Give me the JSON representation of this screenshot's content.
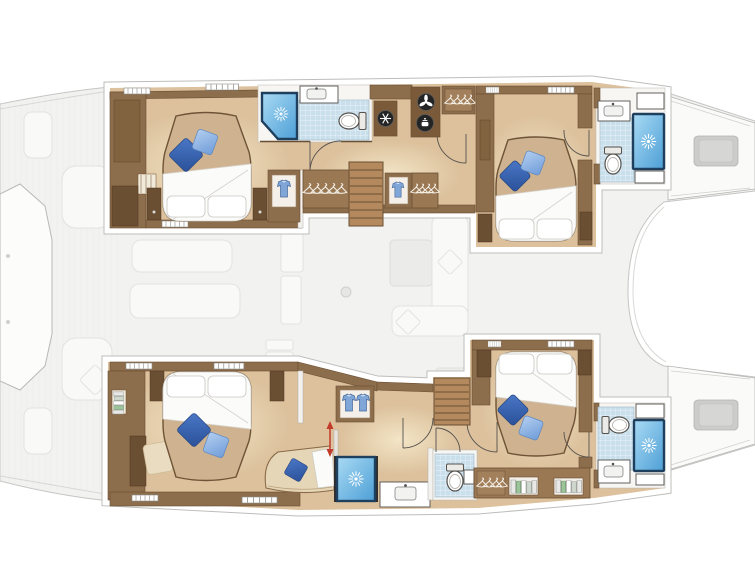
{
  "meta": {
    "title": "Catamaran 4-cabin layout — top-down floor plan",
    "diagram_type": "boat-floor-plan",
    "view": "overhead, lower-deck accommodations highlighted over faded main deck",
    "orientation": "bows to the right, sterns to the left"
  },
  "colors": {
    "page_bg": "#ffffff",
    "deck_faded": "#f2f2f1",
    "deck_outline": "#c5c5c3",
    "deck_furniture": "#f9f9f8",
    "deck_furniture_outline": "#e2e2e0",
    "deck_hatch": "#cccccb",
    "frame_white": "#ffffff",
    "frame_outline": "#bdbdbb",
    "floor_wood": "#dcc19c",
    "floor_glow": "#f4e7c9",
    "wall_wood": "#8d6e4c",
    "wood_dark": "#6b4f33",
    "furniture_wood": "#7b5a3a",
    "wardrobe_wood": "#9a7854",
    "stair_wood": "#b3895d",
    "bed_base": "#cfb390",
    "bed_outline": "#6e5336",
    "linen_white": "#fbfbfa",
    "linen_shadow": "#d6d4cf",
    "pillow_dark_1": "#4a77c6",
    "pillow_dark_2": "#2b5199",
    "pillow_light_1": "#b3cef0",
    "pillow_light_2": "#6f9cd8",
    "bath_floor": "#f7f6f3",
    "tile_blue": "#c9dfeb",
    "shower_glass_1": "#a9daf4",
    "shower_glass_2": "#4d9fd6",
    "shower_frame": "#1f3f5e",
    "fixture_white": "#ffffff",
    "fixture_line": "#55524e",
    "appliance_black": "#242424",
    "shirt_blue": "#7fa6d6",
    "accent_red": "#c23b2a",
    "rug_beige": "#e9dcc0",
    "chaise_beige": "#e6d6b8"
  },
  "counts": {
    "cabins": 4,
    "double_beds": 4,
    "bathrooms": 3,
    "separate_wc": 1,
    "separate_shower": 1,
    "washbasins": 4,
    "toilets": 4,
    "showers": 4,
    "staircases": 2
  },
  "port_hull": {
    "aft_cabin": {
      "fixtures": [
        "double-island-bed",
        "white-duvet",
        "two-white-pillows",
        "dark-blue-cushion",
        "light-blue-cushion",
        "bedside-lockers",
        "wood-paneling",
        "hull-hatches"
      ]
    },
    "aft_bathroom": {
      "fixtures": [
        "corner-shower",
        "washbasin",
        "toilet",
        "tiled-floor",
        "door"
      ]
    },
    "companionway": {
      "fixtures": [
        "staircase",
        "hanging-locker",
        "wardrobe-with-shirt",
        "doors"
      ]
    },
    "galley_units": {
      "appliances": [
        "vent-fan",
        "stove",
        "refrigerator"
      ]
    },
    "forward_cabin": {
      "fixtures": [
        "double-island-bed",
        "white-duvet",
        "two-white-pillows",
        "dark-blue-cushion",
        "light-blue-cushion",
        "bedside-lockers",
        "door"
      ]
    },
    "forward_bathroom": {
      "fixtures": [
        "washbasin",
        "toilet",
        "shower",
        "tiled-floor",
        "shelves"
      ]
    }
  },
  "starboard_hull": {
    "aft_cabin": {
      "fixtures": [
        "double-island-bed",
        "white-duvet",
        "two-white-pillows",
        "dark-blue-cushion",
        "light-blue-cushion",
        "chaise-longue",
        "rug",
        "bookshelf",
        "bedside-lockers",
        "red-arrow-marker"
      ]
    },
    "shower_room": {
      "fixtures": [
        "square-shower"
      ]
    },
    "washbasin_counter": {
      "fixtures": [
        "washbasin"
      ]
    },
    "wc_room": {
      "fixtures": [
        "toilet",
        "corner-basin",
        "tiled-floor",
        "door"
      ]
    },
    "companionway": {
      "fixtures": [
        "staircase",
        "wardrobe-with-shirts",
        "doors"
      ]
    },
    "forward_cabin": {
      "fixtures": [
        "double-island-bed",
        "white-duvet",
        "two-white-pillows",
        "dark-blue-cushion",
        "light-blue-cushion",
        "hanging-locker",
        "shelves"
      ]
    },
    "forward_bathroom": {
      "fixtures": [
        "toilet",
        "shower",
        "washbasin",
        "tiled-floor",
        "shelves"
      ]
    }
  },
  "deck_level_faded": {
    "aft_platform": "octagonal-platform",
    "cockpit": [
      "bench-seats",
      "cushions",
      "table"
    ],
    "saloon": [
      "l-shaped-sofa",
      "table",
      "cushions",
      "mast-post"
    ],
    "foredeck": [
      "deck-hatches",
      "gunwale-lines"
    ]
  }
}
